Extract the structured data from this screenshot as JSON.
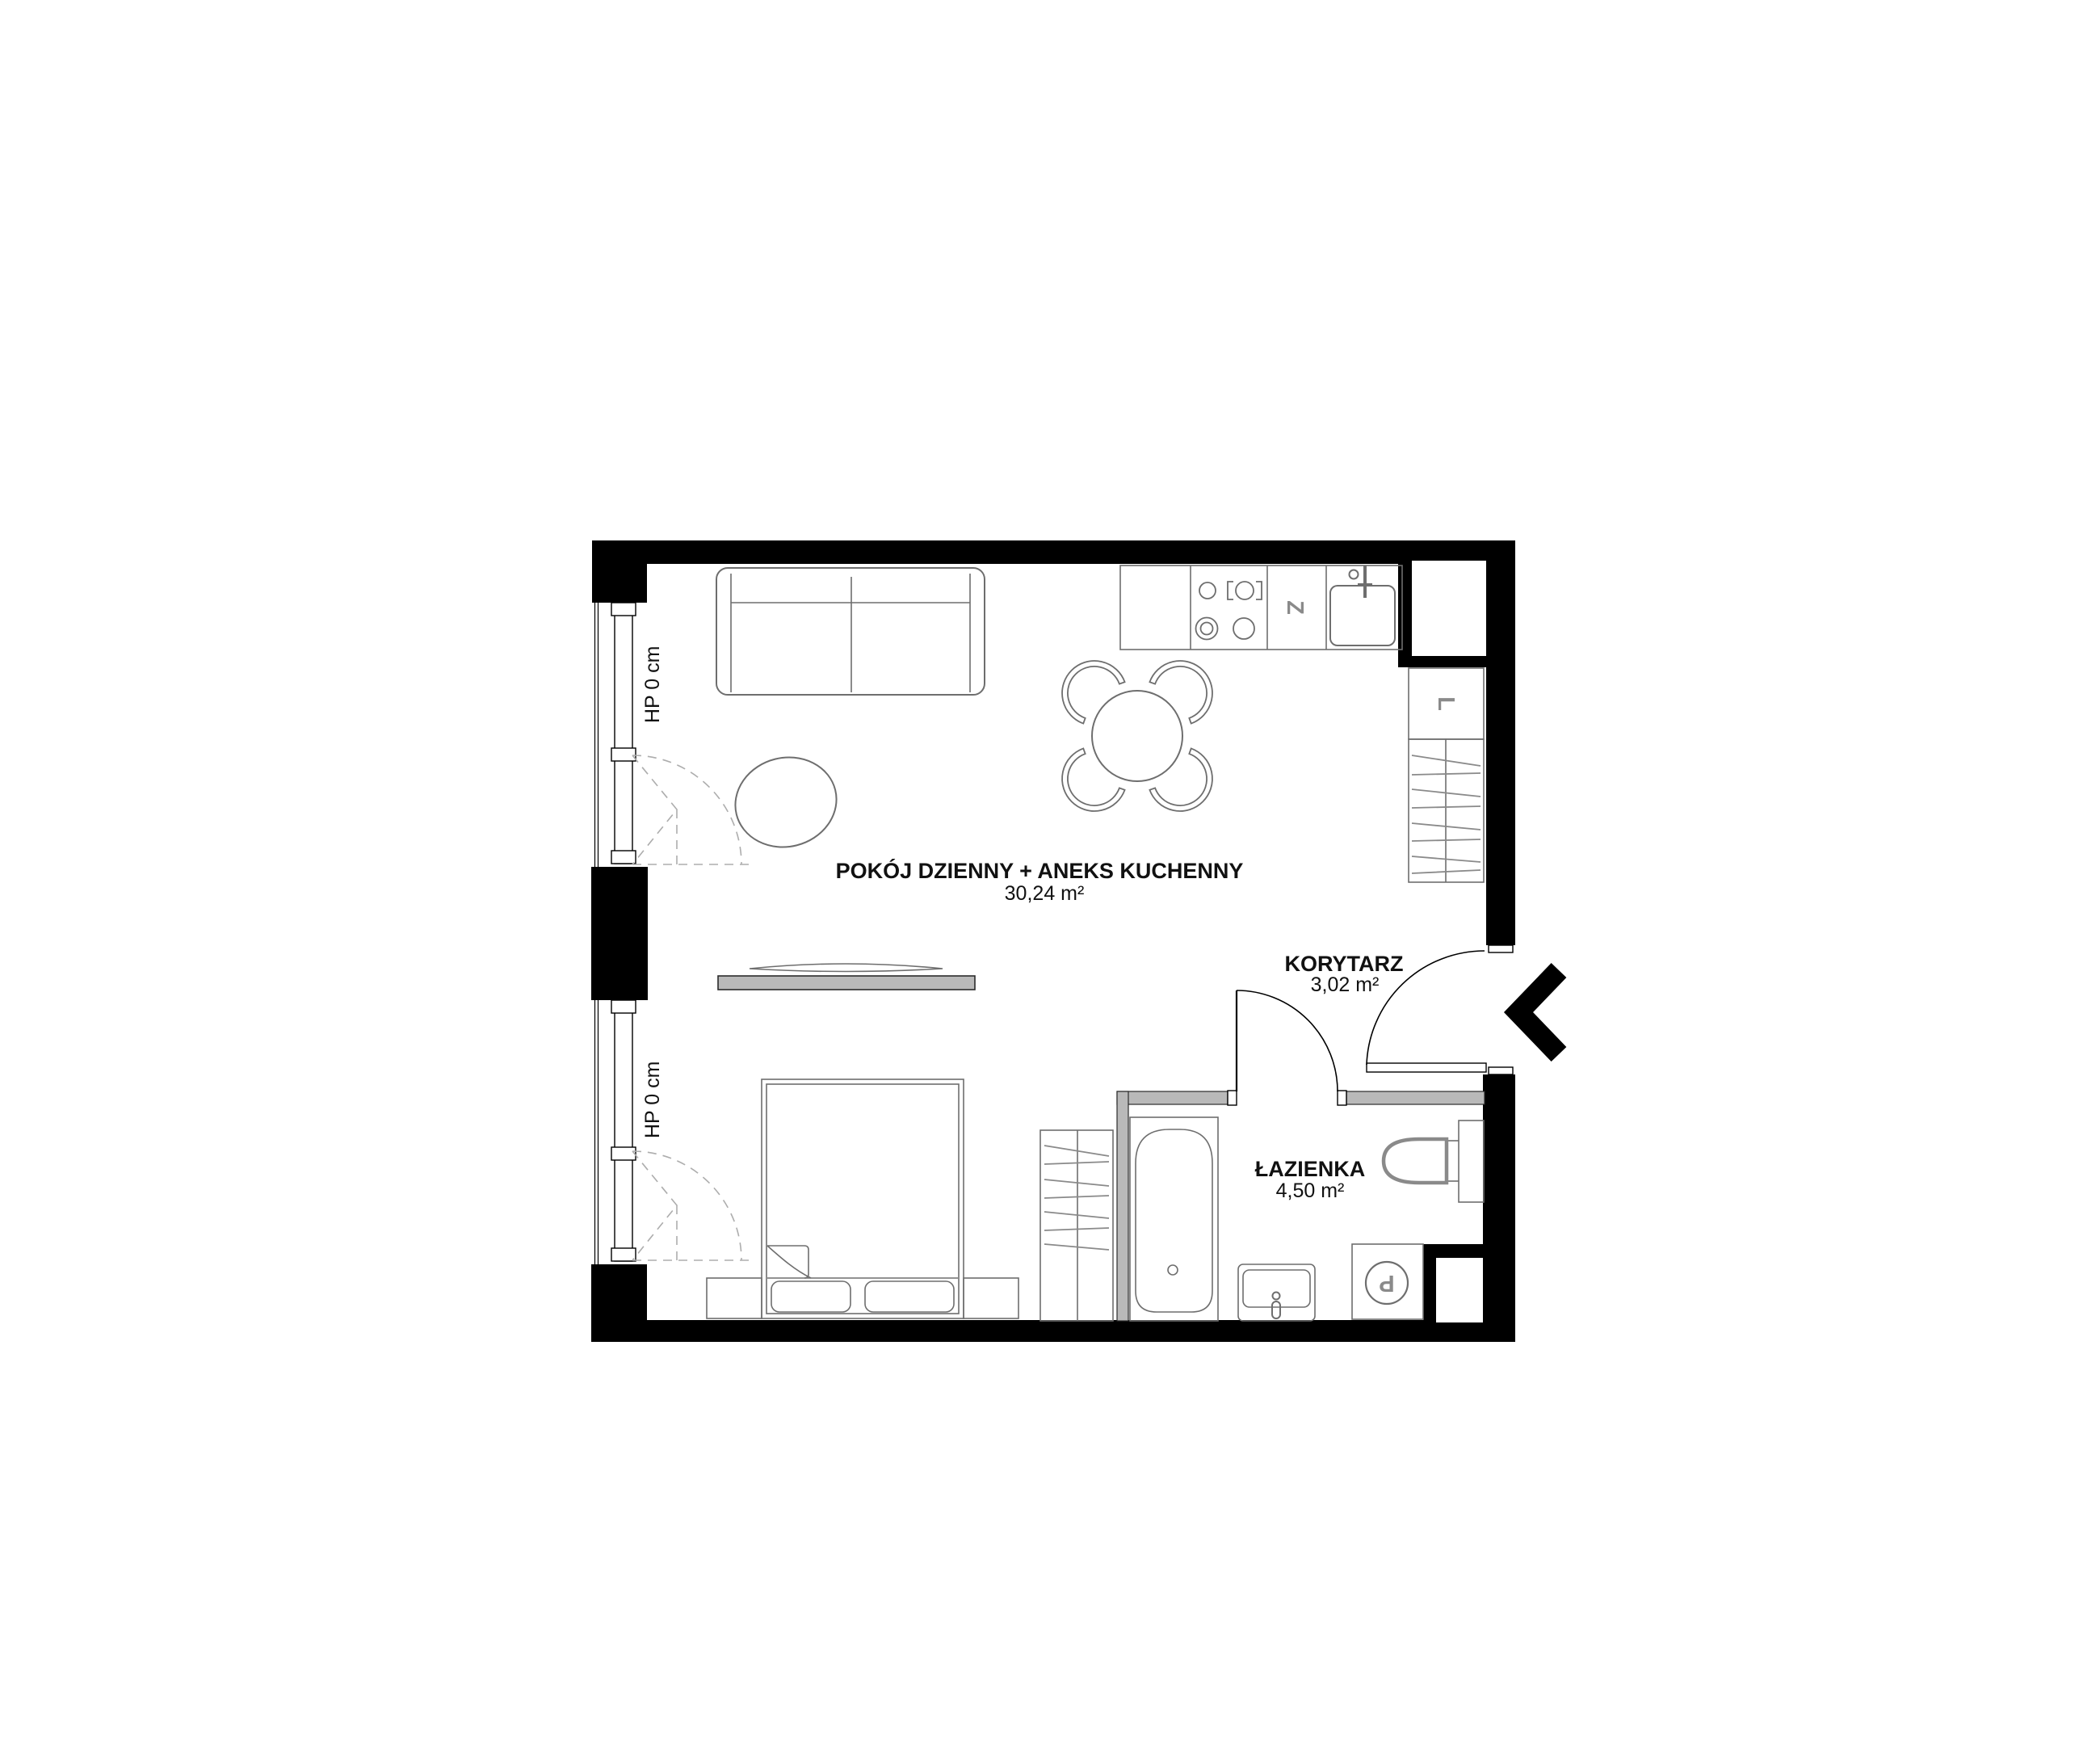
{
  "plan": {
    "title": "apartment-floor-plan",
    "rooms": [
      {
        "id": "living-kitchen",
        "name": "POKÓJ DZIENNY + ANEKS KUCHENNY",
        "area": "30,24 m²"
      },
      {
        "id": "corridor",
        "name": "KORYTARZ",
        "area": "3,02 m²"
      },
      {
        "id": "bathroom",
        "name": "ŁAZIENKA",
        "area": "4,50 m²"
      }
    ],
    "windows": [
      {
        "id": "window-upper",
        "label": "HP 0 cm"
      },
      {
        "id": "window-lower",
        "label": "HP 0 cm"
      }
    ],
    "appliances": {
      "dishwasher": "Z",
      "fridge": "L",
      "washer": "P"
    },
    "colors": {
      "wall": "#000000",
      "partition_wall": "#b9b9b9",
      "furniture_line": "#6e6e6e",
      "appliance_letter": "#8a8a8a",
      "dashed_symbol": "#adadad",
      "background": "#ffffff"
    }
  }
}
